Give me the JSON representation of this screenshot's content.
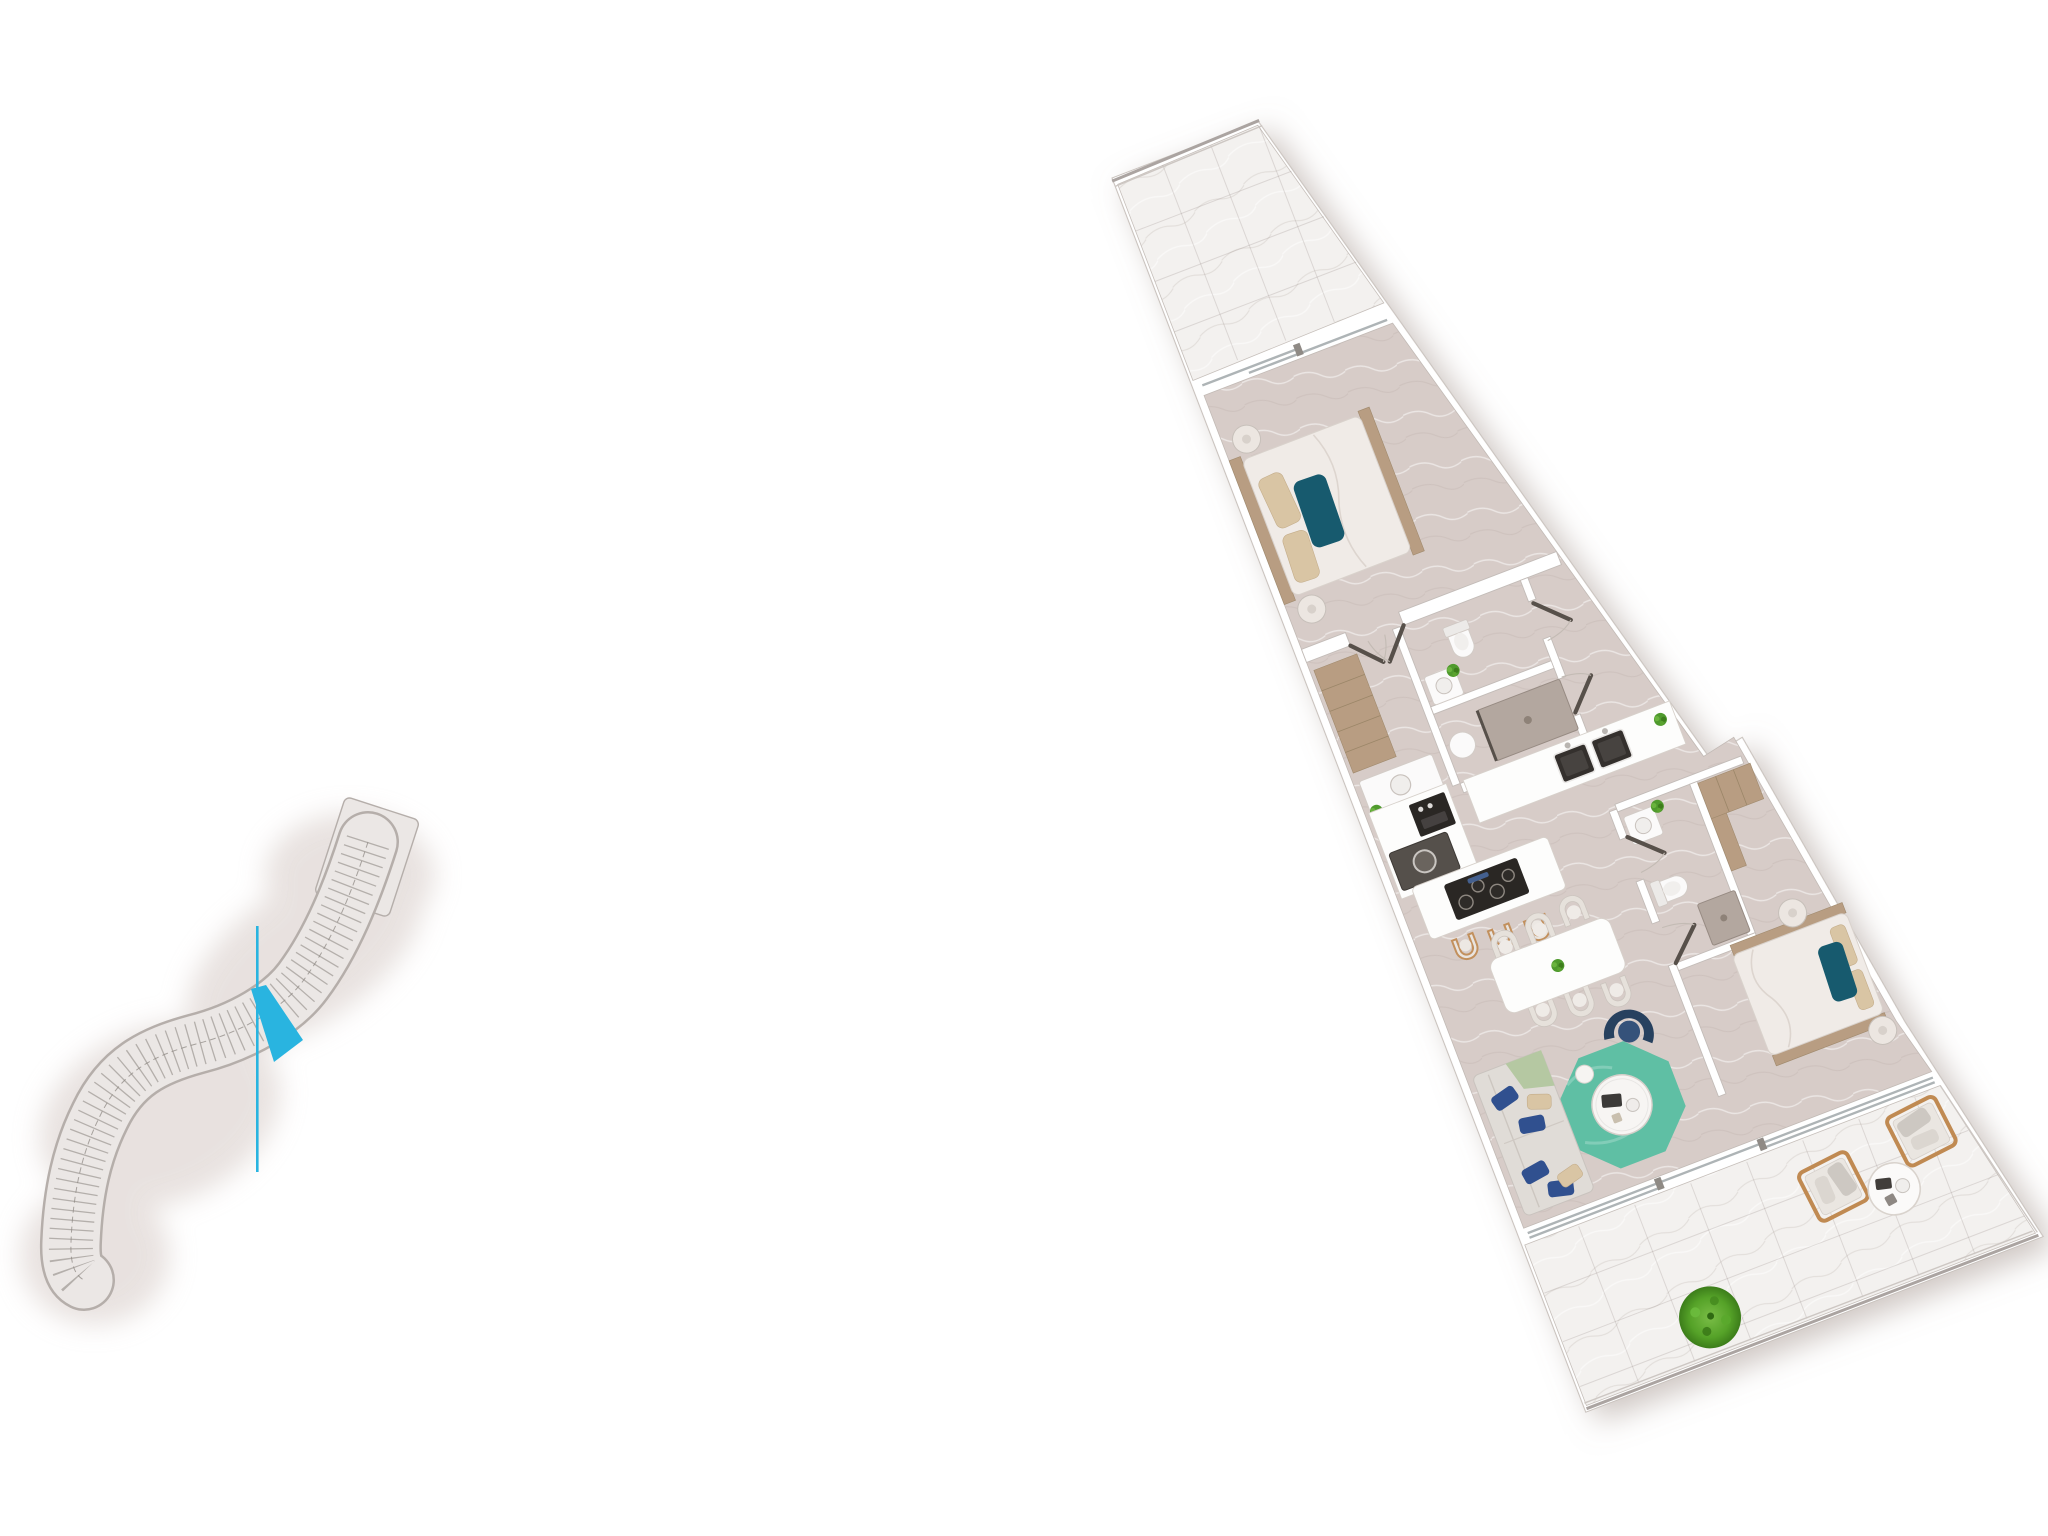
{
  "scene": {
    "description": "3D rendered architectural floor plan of an apartment with a site key plan locator",
    "background_color": "#ffffff"
  },
  "palette": {
    "accent_cyan": "#29b4e0",
    "wall_edge": "#c3bcb8",
    "floor_interior": "#d7ccc8",
    "floor_terrace": "#f3f1ef",
    "wood": "#b89d82",
    "door_leaf": "#57504a",
    "glass": "#aeb4b6",
    "rug_teal": "#5fbfa4",
    "navy_chair": "#27415f",
    "navy_pillow": "#30508f",
    "teal_pillow": "#175a6e",
    "beige_pillow": "#d9c5a4",
    "sofa_gray": "#e0dcd7",
    "sage_throw": "#b5c8a2",
    "bed_white": "#f0ebe7",
    "counter_white": "#fdfdfc",
    "appliance_dark": "#2a2724",
    "washer_gray": "#55504b",
    "shower_tray": "#b3a79f",
    "plant_green": "#4f9a2d",
    "stool_wood": "#c2905d",
    "outdoor_wood": "#c08a52",
    "keyplan_band": "#ebe7e5",
    "keyplan_edge": "#b5aeaa",
    "keyplan_line": "#7d7772"
  },
  "key_plan": {
    "building_shape": "s-curve-slab",
    "highlighted_unit_color": "#29b4e0",
    "has_locator_line": true
  },
  "apartment": {
    "rotation_deg": -21,
    "rooms": [
      "terrace-north",
      "bedroom-1",
      "corridor",
      "bathroom-1",
      "shower-room",
      "kitchen",
      "dining-area",
      "living-area",
      "bedroom-2",
      "ensuite-bathroom",
      "terrace-south"
    ],
    "furniture": {
      "bedroom_1": [
        "double-bed",
        "teal-accent-pillow",
        "beige-pillows",
        "headboard-bench",
        "foot-bench",
        "two-round-nightstands"
      ],
      "corridor": [
        "wardrobe",
        "washbasin-counter",
        "plant"
      ],
      "bathroom_1": [
        "toilet",
        "washbasin",
        "plant"
      ],
      "shower_room": [
        "shower-tray",
        "pedestal-washbasin"
      ],
      "kitchen": [
        "counter-with-double-sink",
        "tall-cabinet",
        "oven",
        "washer",
        "island-with-cooktop",
        "three-bar-stools",
        "plant"
      ],
      "dining_area": [
        "rectangular-table",
        "six-arch-chairs",
        "table-plant"
      ],
      "living_area": [
        "l-shaped-sofa",
        "navy-pillows",
        "beige-pillows",
        "sage-throw",
        "navy-curved-armchair",
        "octagonal-teal-rug",
        "round-coffee-table",
        "small-side-table"
      ],
      "bedroom_2": [
        "double-bed",
        "teal-accent-pillow",
        "wardrobe",
        "two-round-nightstands"
      ],
      "ensuite_bathroom": [
        "toilet",
        "washbasin",
        "shower",
        "plant"
      ],
      "terrace_south": [
        "two-lounge-chairs",
        "round-side-table",
        "green-shrub"
      ],
      "terrace_north": [
        "railing"
      ]
    }
  }
}
